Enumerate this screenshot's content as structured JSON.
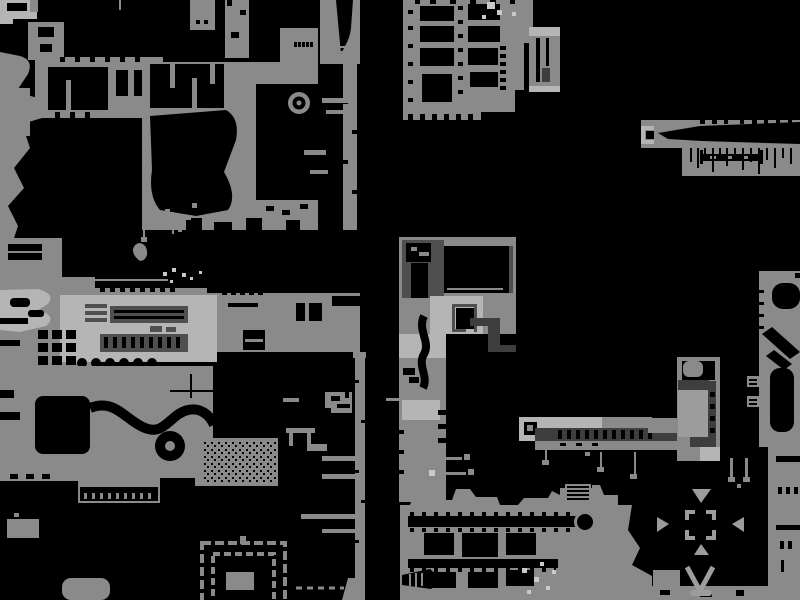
{
  "app": {
    "name": "game-level-map",
    "view": "full map overview"
  },
  "colors": {
    "background": "#000000",
    "base": "#8a8a8a",
    "light": "#b5b5b5",
    "lighter": "#c9c9c9",
    "mid": "#9c9c9c",
    "dark": "#4f4f4f",
    "darker": "#3e3e3e"
  },
  "map": {
    "regions": [
      {
        "name": "top-left-corner-block"
      },
      {
        "name": "left-mass-with-room-frame"
      },
      {
        "name": "central-top-mass-with-ring"
      },
      {
        "name": "top-right-room-grid"
      },
      {
        "name": "small-door-complex"
      },
      {
        "name": "far-right-toothed-corridor"
      },
      {
        "name": "mid-left-band-with-machinery"
      },
      {
        "name": "lower-left-mass-with-corridors"
      },
      {
        "name": "rubble-field"
      },
      {
        "name": "spiral-maze"
      },
      {
        "name": "mid-vertical-strip"
      },
      {
        "name": "nested-structure"
      },
      {
        "name": "bottom-center-room-block"
      },
      {
        "name": "compass-room"
      },
      {
        "name": "train-corridor"
      },
      {
        "name": "tower-structure"
      },
      {
        "name": "right-edge-column"
      }
    ],
    "markers": [
      "ring-marker",
      "compass-brackets",
      "arrow-down",
      "arrow-right",
      "arrow-left",
      "arrow-up",
      "chevron-v",
      "spiral-rings",
      "teardrop-screw"
    ]
  }
}
